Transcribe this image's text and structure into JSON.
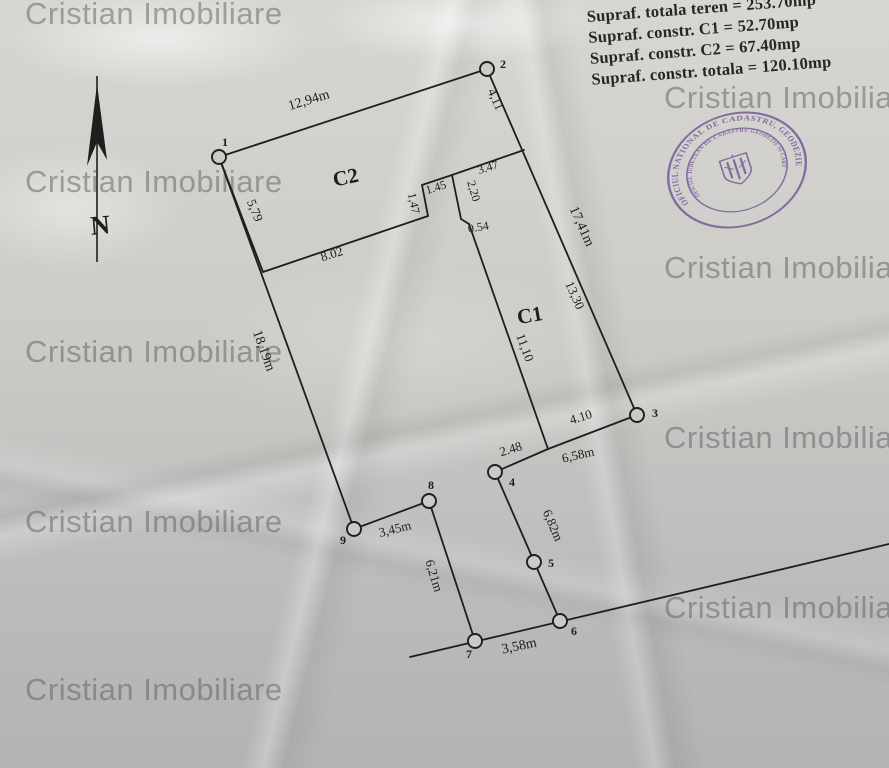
{
  "page": {
    "ink": "#1e1e1e",
    "paper_fill": "#cbcac7"
  },
  "watermark": {
    "text": "Cristian Imobiliare",
    "color": "rgba(95,97,95,0.52)",
    "positions": [
      {
        "x": 25,
        "y": -4
      },
      {
        "x": 664,
        "y": 80
      },
      {
        "x": 25,
        "y": 164
      },
      {
        "x": 664,
        "y": 250
      },
      {
        "x": 25,
        "y": 334
      },
      {
        "x": 664,
        "y": 420
      },
      {
        "x": 25,
        "y": 504
      },
      {
        "x": 664,
        "y": 590
      },
      {
        "x": 25,
        "y": 672
      }
    ]
  },
  "title_block": {
    "lines": [
      "Supraf. totala teren = 253.70mp",
      "Supraf. constr. C1 = 52.70mp",
      "Supraf. constr. C2 = 67.40mp",
      "Supraf. constr. totala = 120.10mp"
    ]
  },
  "north_arrow": {
    "label": "N",
    "x": 97,
    "line_top": 76,
    "line_bottom": 262
  },
  "stamp": {
    "color": "#6d4f92",
    "outer_text": "OFICIUL NATIONAL DE CADASTRU, GEODEZIE SI CARTOGRAFIE •",
    "inner_text": "OFICIUL JUDETEAN DE CADASTRU GEODEZIE SI CARTOGRAFIE BRAILA"
  },
  "plan": {
    "segments": [
      {
        "name": "boundary-1-2",
        "x1": 219,
        "y1": 157,
        "x2": 487,
        "y2": 69
      },
      {
        "name": "boundary-2-3",
        "x1": 487,
        "y1": 69,
        "x2": 637,
        "y2": 415
      },
      {
        "name": "boundary-3-c1corner",
        "x1": 637,
        "y1": 415,
        "x2": 548,
        "y2": 449
      },
      {
        "name": "boundary-c1corner-4",
        "x1": 548,
        "y1": 449,
        "x2": 495,
        "y2": 472
      },
      {
        "name": "boundary-4-5-6",
        "x1": 495,
        "y1": 472,
        "x2": 560,
        "y2": 621
      },
      {
        "name": "street-line-6-7",
        "x1": 410,
        "y1": 657,
        "x2": 889,
        "y2": 544
      },
      {
        "name": "boundary-7-8",
        "x1": 475,
        "y1": 641,
        "x2": 429,
        "y2": 501
      },
      {
        "name": "boundary-8-9",
        "x1": 429,
        "y1": 501,
        "x2": 354,
        "y2": 529
      },
      {
        "name": "boundary-9-1",
        "x1": 354,
        "y1": 529,
        "x2": 219,
        "y2": 157
      },
      {
        "name": "c2-left",
        "x1": 219,
        "y1": 157,
        "x2": 263,
        "y2": 272
      },
      {
        "name": "c2-bottom",
        "x1": 263,
        "y1": 272,
        "x2": 428,
        "y2": 216
      },
      {
        "name": "c2-notch-147",
        "x1": 428,
        "y1": 216,
        "x2": 422,
        "y2": 185
      },
      {
        "name": "c2-notch-145",
        "x1": 422,
        "y1": 185,
        "x2": 452,
        "y2": 175
      },
      {
        "name": "c2-c1-top-347",
        "x1": 452,
        "y1": 175,
        "x2": 524,
        "y2": 150
      },
      {
        "name": "c1-left-220",
        "x1": 452,
        "y1": 175,
        "x2": 461,
        "y2": 219
      },
      {
        "name": "c1-step-054",
        "x1": 461,
        "y1": 219,
        "x2": 469,
        "y2": 224
      },
      {
        "name": "c1-left-1110",
        "x1": 469,
        "y1": 224,
        "x2": 548,
        "y2": 449
      }
    ],
    "points": [
      {
        "n": "1",
        "x": 219,
        "y": 157,
        "lx": 222,
        "ly": 146
      },
      {
        "n": "2",
        "x": 487,
        "y": 69,
        "lx": 500,
        "ly": 68
      },
      {
        "n": "3",
        "x": 637,
        "y": 415,
        "lx": 652,
        "ly": 417
      },
      {
        "n": "4",
        "x": 495,
        "y": 472,
        "lx": 509,
        "ly": 486
      },
      {
        "n": "5",
        "x": 534,
        "y": 562,
        "lx": 548,
        "ly": 567
      },
      {
        "n": "6",
        "x": 560,
        "y": 621,
        "lx": 571,
        "ly": 635
      },
      {
        "n": "7",
        "x": 475,
        "y": 641,
        "lx": 466,
        "ly": 658
      },
      {
        "n": "8",
        "x": 429,
        "y": 501,
        "lx": 428,
        "ly": 489
      },
      {
        "n": "9",
        "x": 354,
        "y": 529,
        "lx": 340,
        "ly": 544
      }
    ],
    "dim_labels": [
      {
        "text": "12,94m",
        "x": 310,
        "y": 104,
        "rot": -17,
        "size": 14
      },
      {
        "text": "4,11",
        "x": 492,
        "y": 101,
        "rot": 66,
        "size": 13
      },
      {
        "text": "5,79",
        "x": 251,
        "y": 212,
        "rot": 68,
        "size": 13
      },
      {
        "text": "8.02",
        "x": 333,
        "y": 258,
        "rot": -17,
        "size": 13
      },
      {
        "text": "1.45",
        "x": 437,
        "y": 191,
        "rot": -17,
        "size": 12
      },
      {
        "text": "1,47",
        "x": 410,
        "y": 204,
        "rot": 78,
        "size": 12
      },
      {
        "text": "2,20",
        "x": 470,
        "y": 192,
        "rot": 74,
        "size": 12
      },
      {
        "text": "3.47",
        "x": 489,
        "y": 171,
        "rot": -17,
        "size": 12
      },
      {
        "text": "0.54",
        "x": 479,
        "y": 231,
        "rot": -10,
        "size": 12
      },
      {
        "text": "17,41m",
        "x": 578,
        "y": 228,
        "rot": 66,
        "size": 14
      },
      {
        "text": "13,30",
        "x": 571,
        "y": 297,
        "rot": 66,
        "size": 13
      },
      {
        "text": "11,10",
        "x": 521,
        "y": 349,
        "rot": 70,
        "size": 13
      },
      {
        "text": "4.10",
        "x": 582,
        "y": 421,
        "rot": -17,
        "size": 13
      },
      {
        "text": "2.48",
        "x": 512,
        "y": 453,
        "rot": -17,
        "size": 13
      },
      {
        "text": "6,58m",
        "x": 579,
        "y": 459,
        "rot": -13,
        "size": 13
      },
      {
        "text": "18,19m",
        "x": 260,
        "y": 352,
        "rot": 70,
        "size": 14
      },
      {
        "text": "3,45m",
        "x": 396,
        "y": 533,
        "rot": -14,
        "size": 13
      },
      {
        "text": "6,21m",
        "x": 430,
        "y": 577,
        "rot": 73,
        "size": 13
      },
      {
        "text": "6,82m",
        "x": 549,
        "y": 527,
        "rot": 67,
        "size": 13
      },
      {
        "text": "3,58m",
        "x": 520,
        "y": 650,
        "rot": -12,
        "size": 14
      }
    ],
    "buildings": [
      {
        "name": "C2",
        "x": 347,
        "y": 184,
        "rot": -12
      },
      {
        "name": "C1",
        "x": 531,
        "y": 322,
        "rot": -10
      }
    ]
  }
}
